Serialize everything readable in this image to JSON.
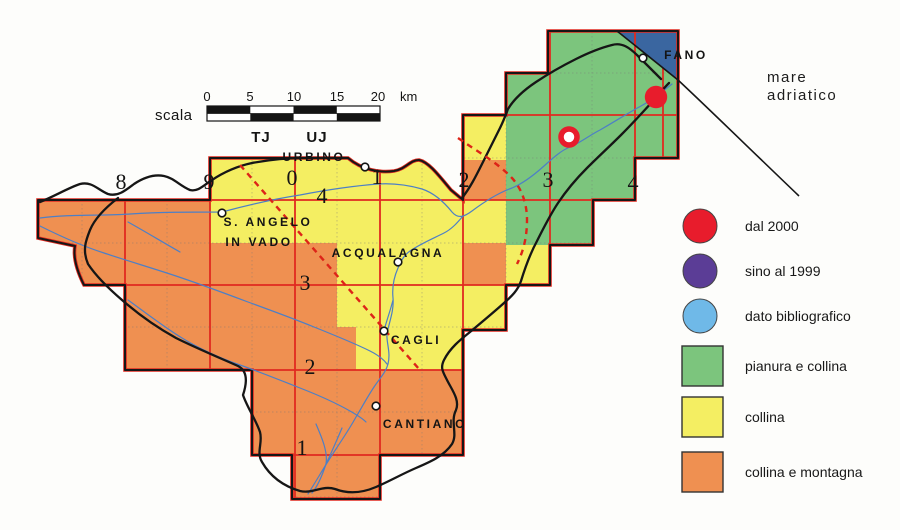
{
  "colors": {
    "green": "#7cc57d",
    "yellow": "#f4ee62",
    "orange": "#ef9051",
    "sea": "#3a66a0",
    "grid_red": "#e02a20",
    "dash_red": "#dd2418",
    "river": "#4d7fc6",
    "marker_red": "#e81c2c",
    "purple": "#5b3d96",
    "light_blue": "#6fb9e8",
    "boundary": "#161616"
  },
  "scale": {
    "label": "scala",
    "ticks": [
      "0",
      "5",
      "10",
      "15",
      "20"
    ],
    "unit": "km",
    "zone_left": "TJ",
    "zone_right": "UJ"
  },
  "sea_label": {
    "line1": "mare",
    "line2": "adriatico"
  },
  "towns": {
    "urbino": "URBINO",
    "sant_angelo_line1": "S. ANGELO",
    "sant_angelo_line2": "IN VADO",
    "acqualagna": "ACQUALAGNA",
    "cagli": "CAGLI",
    "cantiano": "CANTIANO",
    "fano": "FANO"
  },
  "grid_index": {
    "columns": [
      "8",
      "9",
      "0",
      "1",
      "2",
      "3",
      "4"
    ],
    "rows": [
      "4",
      "3",
      "2",
      "1"
    ]
  },
  "legend": {
    "items": [
      {
        "shape": "circle",
        "color": "#e81c2c",
        "label": "dal 2000"
      },
      {
        "shape": "circle",
        "color": "#5b3d96",
        "label": "sino al 1999"
      },
      {
        "shape": "circle",
        "color": "#6fb9e8",
        "label": "dato bibliografico"
      },
      {
        "shape": "square",
        "color": "#7cc57d",
        "label": "pianura e collina"
      },
      {
        "shape": "square",
        "color": "#f4ee62",
        "label": "collina"
      },
      {
        "shape": "square",
        "color": "#ef9051",
        "label": "collina e montagna"
      }
    ]
  }
}
